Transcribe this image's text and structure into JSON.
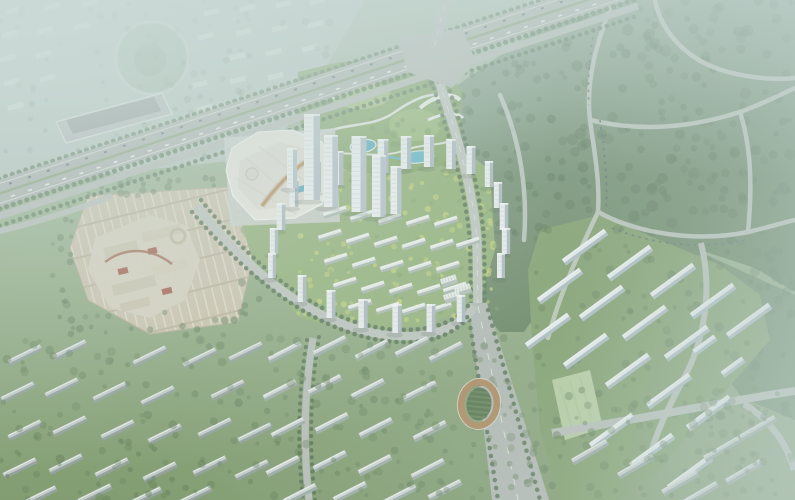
{
  "meta": {
    "description": "aerial-masterplan-architectural-rendering",
    "width": 795,
    "height": 500
  },
  "palette": {
    "haze": "#c6d6d2",
    "forest": "#56734e",
    "forest_hazy": "#8aa492",
    "estate_lawn": "#8fae70",
    "yellow_trees": "#c7d56f",
    "road": "#b6bab4",
    "highway": "#a8ada7",
    "parking": "#cec2a9",
    "building_white": "#f0f3f2",
    "building_shade": "#a9b6bd",
    "mall_roof": "#eceade",
    "amber_accent": "#b98a4e",
    "pool_blue": "#4fa9bf",
    "track_tan": "#ad8355",
    "track_field": "#4c6b40",
    "city_wash": "#b9c5bf"
  },
  "scene": {
    "tree_fields": [
      {
        "target": "g-trees-city",
        "x": 0,
        "y": 0,
        "w": 335,
        "h": 160,
        "n": 90,
        "fill": "#74907c",
        "op": 0.42,
        "rmin": 2,
        "rmax": 4,
        "seed": 11
      },
      {
        "target": "g-trees-forest",
        "x": 560,
        "y": 0,
        "w": 235,
        "h": 250,
        "n": 170,
        "fill": "#4e6b4b",
        "op": 0.5,
        "rmin": 2.5,
        "rmax": 6,
        "seed": 21
      },
      {
        "target": "g-trees-forest",
        "x": 448,
        "y": 60,
        "w": 115,
        "h": 190,
        "n": 70,
        "fill": "#4e6b4b",
        "op": 0.5,
        "rmin": 2.5,
        "rmax": 5,
        "seed": 22
      },
      {
        "target": "g-trees-forest",
        "x": 700,
        "y": 250,
        "w": 95,
        "h": 170,
        "n": 55,
        "fill": "#4e6b4b",
        "op": 0.5,
        "rmin": 2.5,
        "rmax": 5.5,
        "seed": 23
      },
      {
        "target": "g-trees-forest",
        "x": 530,
        "y": 250,
        "w": 60,
        "h": 90,
        "n": 30,
        "fill": "#4e6b4b",
        "op": 0.5,
        "rmin": 2,
        "rmax": 5,
        "seed": 24
      },
      {
        "target": "g-trees-hill",
        "x": 535,
        "y": 225,
        "w": 230,
        "h": 250,
        "n": 90,
        "fill": "#557249",
        "op": 0.5,
        "rmin": 2,
        "rmax": 5,
        "seed": 31
      },
      {
        "target": "g-trees-estate",
        "x": 298,
        "y": 168,
        "w": 200,
        "h": 158,
        "n": 110,
        "fill": "#c7d56f",
        "op": 0.75,
        "rmin": 1.5,
        "rmax": 3.2,
        "seed": 41
      },
      {
        "target": "g-trees-estate",
        "x": 298,
        "y": 168,
        "w": 200,
        "h": 158,
        "n": 55,
        "fill": "#7da05c",
        "op": 0.6,
        "rmin": 1.5,
        "rmax": 3,
        "seed": 42
      },
      {
        "target": "g-trees-park",
        "x": 302,
        "y": 72,
        "w": 156,
        "h": 96,
        "n": 46,
        "fill": "#6f9355",
        "op": 0.7,
        "rmin": 2,
        "rmax": 4,
        "seed": 51
      },
      {
        "target": "g-trees-bottom",
        "x": 0,
        "y": 336,
        "w": 545,
        "h": 164,
        "n": 230,
        "fill": "#5b7850",
        "op": 0.5,
        "rmin": 2,
        "rmax": 4.5,
        "seed": 61
      },
      {
        "target": "g-trees-bottom",
        "x": 545,
        "y": 390,
        "w": 250,
        "h": 110,
        "n": 70,
        "fill": "#567247",
        "op": 0.5,
        "rmin": 2,
        "rmax": 4.5,
        "seed": 62
      },
      {
        "target": "g-trees-parking",
        "x": 60,
        "y": 176,
        "w": 200,
        "h": 20,
        "n": 22,
        "fill": "#5a7750",
        "op": 0.6,
        "rmin": 2,
        "rmax": 4,
        "seed": 71
      },
      {
        "target": "g-trees-parking",
        "x": 58,
        "y": 312,
        "w": 190,
        "h": 24,
        "n": 22,
        "fill": "#5a7750",
        "op": 0.6,
        "rmin": 2,
        "rmax": 4,
        "seed": 72
      },
      {
        "target": "g-trees-parking",
        "x": 52,
        "y": 200,
        "w": 20,
        "h": 118,
        "n": 14,
        "fill": "#5a7750",
        "op": 0.6,
        "rmin": 2,
        "rmax": 4,
        "seed": 73
      },
      {
        "target": "g-trees-parking",
        "x": 238,
        "y": 196,
        "w": 26,
        "h": 120,
        "n": 16,
        "fill": "#5a7750",
        "op": 0.6,
        "rmin": 2,
        "rmax": 4,
        "seed": 74
      }
    ],
    "slab_groups": [
      {
        "target": "g-city-blocks",
        "w": 16,
        "h": 9,
        "rot": -14,
        "fill": "#dfe6e2",
        "shade": "#b6c2bc",
        "op": 0.75,
        "ridge": false,
        "pts": [
          [
            14,
            12
          ],
          [
            52,
            8
          ],
          [
            90,
            5
          ],
          [
            212,
            14
          ],
          [
            248,
            10
          ],
          [
            284,
            6
          ],
          [
            318,
            3
          ],
          [
            10,
            36
          ],
          [
            46,
            32
          ],
          [
            82,
            28
          ],
          [
            206,
            38
          ],
          [
            244,
            34
          ],
          [
            280,
            30
          ],
          [
            316,
            26
          ],
          [
            8,
            60
          ],
          [
            44,
            56
          ],
          [
            238,
            58
          ],
          [
            274,
            54
          ],
          [
            310,
            50
          ],
          [
            12,
            84
          ],
          [
            48,
            80
          ],
          [
            200,
            86
          ],
          [
            238,
            82
          ],
          [
            276,
            78
          ],
          [
            16,
            108
          ],
          [
            205,
            110
          ],
          [
            244,
            106
          ]
        ]
      },
      {
        "target": "g-estate-lowrise",
        "w": 24,
        "h": 6,
        "rot": -18,
        "fill": "#edf0ea",
        "shade": "#9fada5",
        "op": 1,
        "ridge": true,
        "pts": [
          [
            335,
            212
          ],
          [
            362,
            216
          ],
          [
            390,
            219
          ],
          [
            418,
            221
          ],
          [
            446,
            222
          ],
          [
            330,
            235
          ],
          [
            358,
            239
          ],
          [
            386,
            242
          ],
          [
            414,
            244
          ],
          [
            442,
            245
          ],
          [
            468,
            243
          ],
          [
            336,
            259
          ],
          [
            364,
            263
          ],
          [
            392,
            266
          ],
          [
            420,
            267
          ],
          [
            448,
            267
          ],
          [
            345,
            283
          ],
          [
            373,
            287
          ],
          [
            401,
            289
          ],
          [
            429,
            290
          ],
          [
            455,
            288
          ],
          [
            360,
            305
          ],
          [
            388,
            308
          ],
          [
            414,
            309
          ],
          [
            440,
            308
          ]
        ]
      },
      {
        "target": "g-townhouses",
        "w": 16,
        "h": 9,
        "rot": -18,
        "fill": "#eef0ec",
        "shade": "#a3b0a9",
        "op": 1,
        "ridge": true,
        "stripes": true,
        "pts": [
          [
            449,
            281
          ],
          [
            463,
            290
          ],
          [
            452,
            297
          ]
        ]
      },
      {
        "target": "g-hill-slabs",
        "w": 52,
        "h": 7.5,
        "rot": -36,
        "fill": "#edf2f2",
        "shade": "#9fb2ba",
        "op": 1,
        "ridge": true,
        "pts": [
          [
            585,
            247
          ],
          [
            630,
            263
          ],
          [
            673,
            281
          ],
          [
            713,
            301
          ],
          [
            749,
            321
          ],
          [
            560,
            286
          ],
          [
            602,
            303
          ],
          [
            645,
            323
          ],
          [
            687,
            343
          ],
          [
            586,
            351
          ],
          [
            628,
            371
          ],
          [
            669,
            391
          ],
          [
            709,
            413
          ],
          [
            612,
            431
          ],
          [
            652,
            451
          ],
          [
            690,
            473
          ],
          [
            548,
            331
          ]
        ]
      },
      {
        "target": "g-hill-slabs",
        "w": 26,
        "h": 7,
        "rot": -36,
        "fill": "#e9efef",
        "shade": "#9fb2ba",
        "op": 1,
        "ridge": true,
        "pts": [
          [
            705,
            345
          ],
          [
            733,
            367
          ]
        ]
      },
      {
        "target": "g-bottom-center-slabs",
        "w": 36,
        "h": 6.5,
        "rot": -27,
        "fill": "#d2d9d4",
        "shade": "#93a19b",
        "op": 1,
        "ridge": true,
        "pts": [
          [
            285,
            352
          ],
          [
            330,
            346
          ],
          [
            372,
            350
          ],
          [
            412,
            347
          ],
          [
            446,
            352
          ],
          [
            280,
            390
          ],
          [
            325,
            385
          ],
          [
            368,
            389
          ],
          [
            420,
            391
          ],
          [
            288,
            428
          ],
          [
            332,
            423
          ],
          [
            376,
            428
          ],
          [
            430,
            431
          ],
          [
            283,
            466
          ],
          [
            330,
            461
          ],
          [
            375,
            465
          ],
          [
            428,
            469
          ],
          [
            300,
            494
          ],
          [
            350,
            492
          ],
          [
            400,
            495
          ],
          [
            445,
            490
          ]
        ]
      },
      {
        "target": "g-bottom-left-slabs",
        "w": 36,
        "h": 6.5,
        "rot": -26,
        "fill": "#c5cdc8",
        "shade": "#87958f",
        "op": 1,
        "ridge": true,
        "pts": [
          [
            25,
            355
          ],
          [
            70,
            350
          ],
          [
            150,
            356
          ],
          [
            200,
            358
          ],
          [
            246,
            352
          ],
          [
            18,
            392
          ],
          [
            62,
            388
          ],
          [
            110,
            392
          ],
          [
            158,
            396
          ],
          [
            228,
            390
          ],
          [
            25,
            430
          ],
          [
            70,
            426
          ],
          [
            118,
            430
          ],
          [
            165,
            434
          ],
          [
            215,
            428
          ],
          [
            255,
            433
          ],
          [
            20,
            468
          ],
          [
            66,
            464
          ],
          [
            112,
            468
          ],
          [
            160,
            472
          ],
          [
            210,
            466
          ],
          [
            252,
            470
          ],
          [
            40,
            496
          ],
          [
            95,
            494
          ],
          [
            145,
            497
          ],
          [
            195,
            496
          ]
        ]
      },
      {
        "target": "g-bottom-right-slabs",
        "w": 40,
        "h": 7,
        "rot": -30,
        "fill": "#ccd3cf",
        "shade": "#8e9c96",
        "op": 1,
        "ridge": true,
        "pts": [
          [
            590,
            452
          ],
          [
            636,
            466
          ],
          [
            680,
            483
          ],
          [
            722,
            449
          ],
          [
            758,
            428
          ],
          [
            744,
            472
          ],
          [
            700,
            494
          ]
        ]
      }
    ],
    "tower_groups": [
      {
        "target": "g-estate-towers",
        "fill": "#f0f3f2",
        "shade": "#a9b6bd",
        "pts": [
          [
            316,
            192,
            32
          ],
          [
            338,
            185,
            34
          ],
          [
            360,
            179,
            33
          ],
          [
            383,
            173,
            34
          ],
          [
            406,
            169,
            33
          ],
          [
            429,
            167,
            32
          ],
          [
            451,
            169,
            30
          ],
          [
            471,
            174,
            28
          ],
          [
            489,
            187,
            26
          ],
          [
            498,
            208,
            26
          ],
          [
            504,
            230,
            27
          ],
          [
            506,
            254,
            26
          ],
          [
            501,
            278,
            25
          ],
          [
            294,
            207,
            28
          ],
          [
            281,
            230,
            27
          ],
          [
            274,
            254,
            26
          ],
          [
            272,
            278,
            25
          ],
          [
            302,
            302,
            27
          ],
          [
            331,
            318,
            28
          ],
          [
            363,
            328,
            29
          ],
          [
            397,
            333,
            29
          ],
          [
            431,
            332,
            28
          ],
          [
            461,
            322,
            27
          ]
        ]
      },
      {
        "target": "g-office-towers",
        "fill": "#f3f5f4",
        "shade": "#b3bfc6",
        "pts": [
          [
            292,
            188,
            40,
            10
          ],
          [
            312,
            200,
            86,
            16
          ],
          [
            331,
            207,
            72,
            14
          ],
          [
            359,
            212,
            76,
            15
          ],
          [
            379,
            217,
            62,
            14
          ],
          [
            396,
            214,
            48,
            11
          ]
        ]
      }
    ]
  }
}
